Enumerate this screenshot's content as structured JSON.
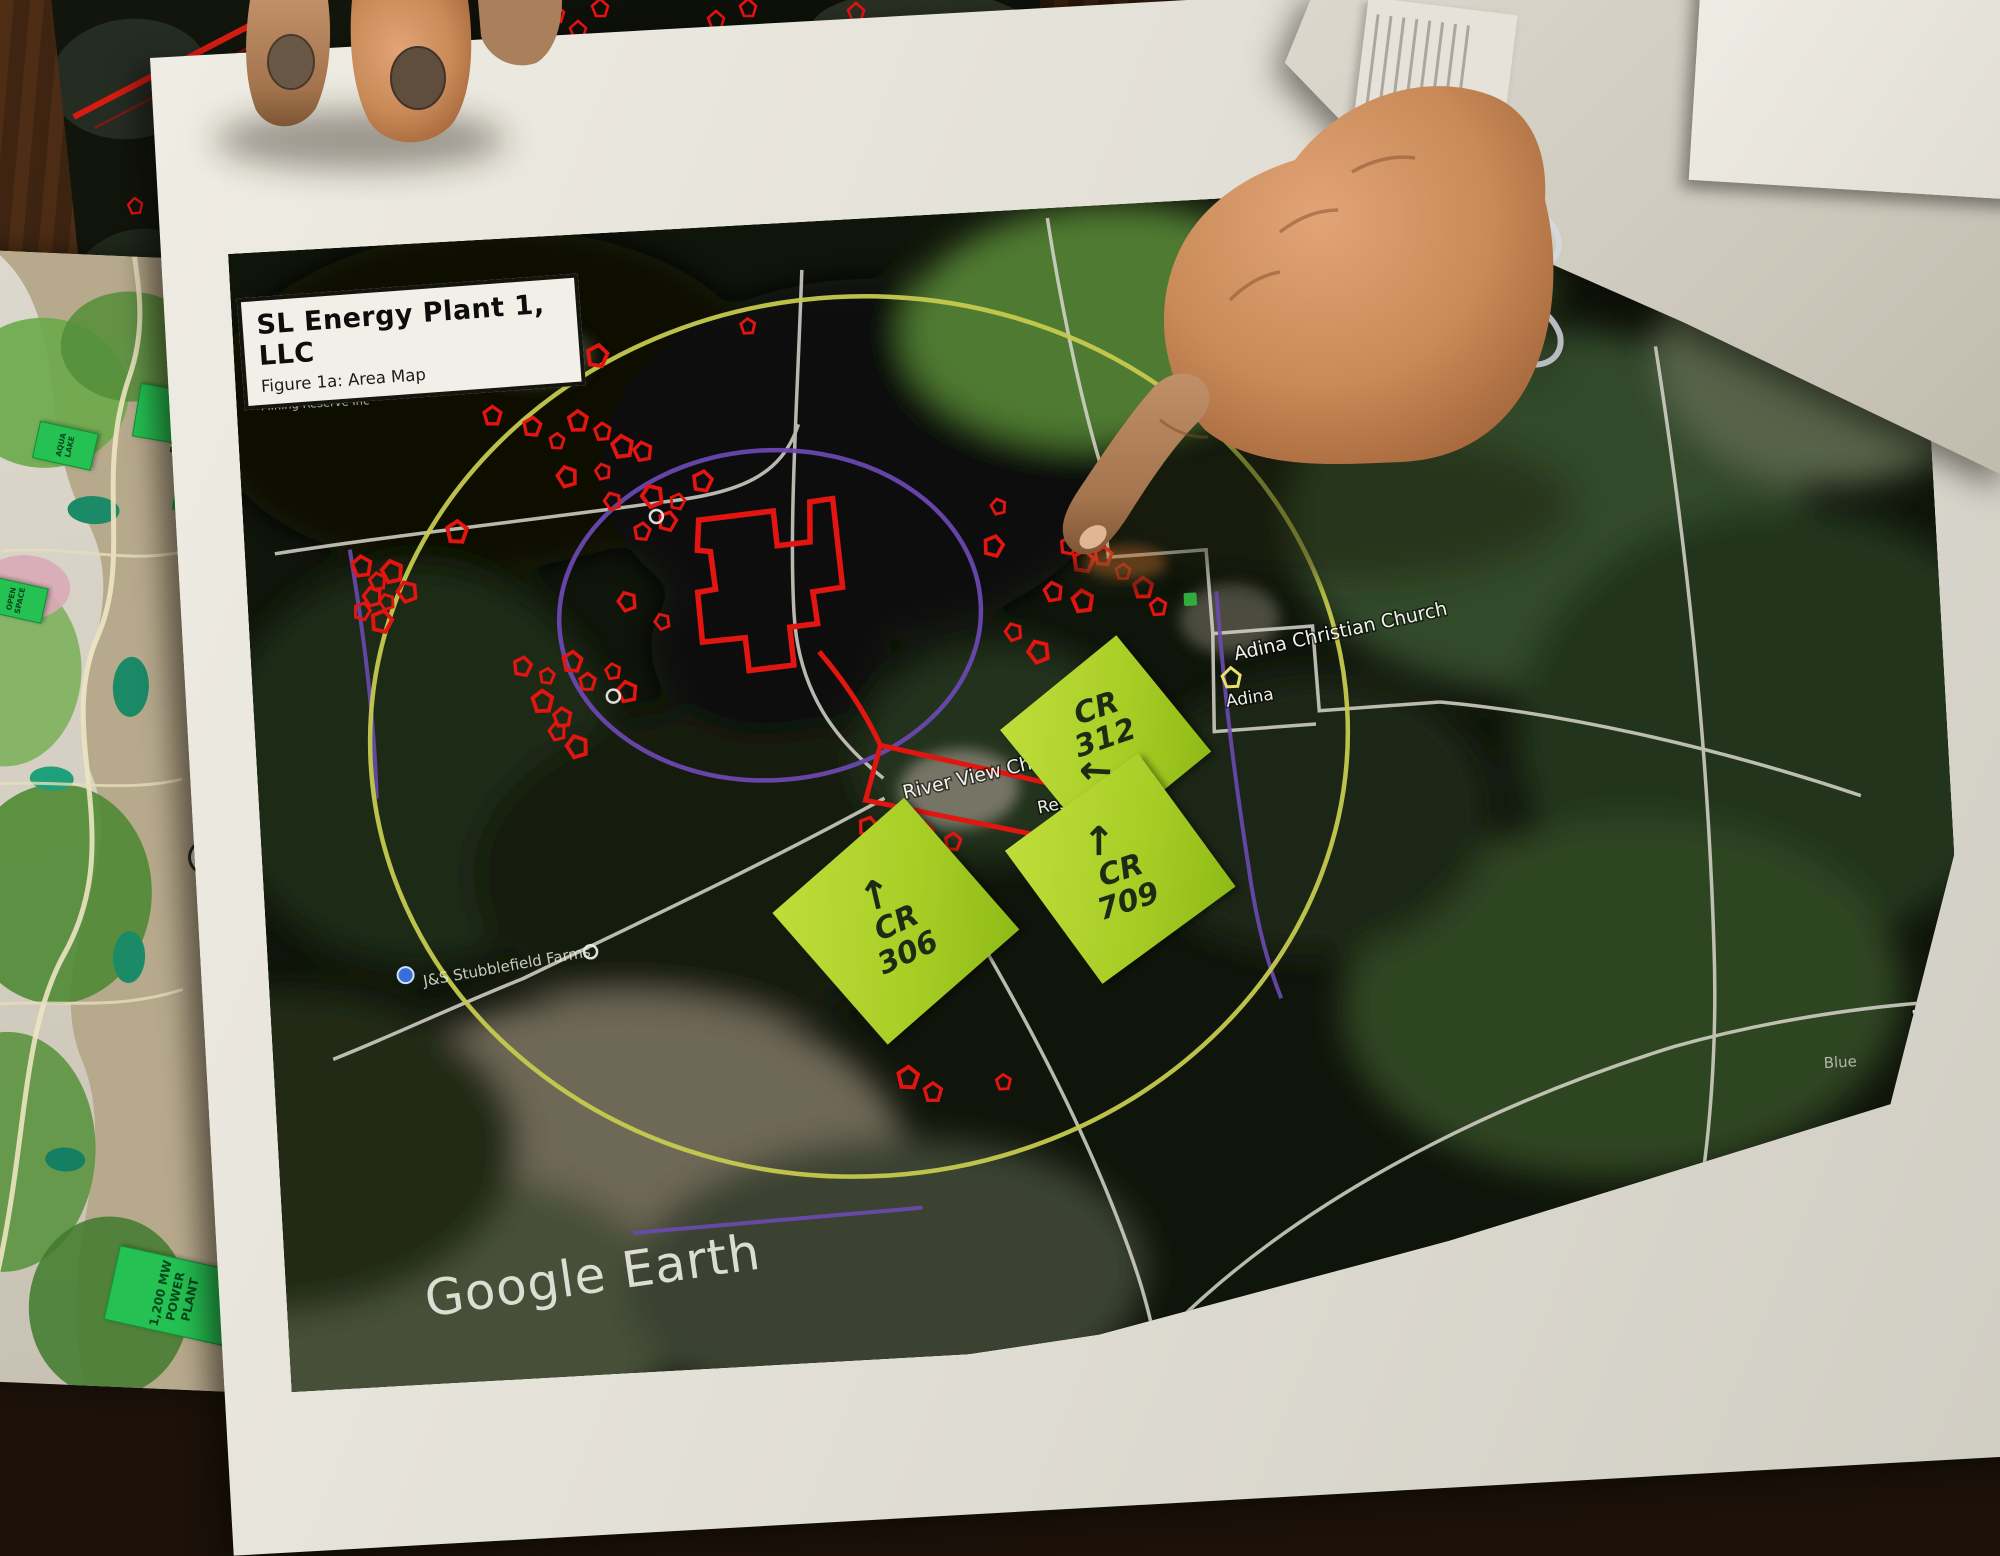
{
  "scene": {
    "caption": "Hand pointing at printed Google Earth area map with sticky notes"
  },
  "main_map": {
    "title": "SL Energy Plant 1, LLC",
    "subtitle": "Figure 1a: Area Map",
    "legend_title": "Legend",
    "watermark": "Google Earth",
    "scale_label": "2 mi",
    "place_labels": {
      "reserve": "Mining Reserve Inc",
      "church": "Adina Christian Church",
      "town": "Adina",
      "academy": "River View Christian Academy",
      "residence": "Residence",
      "farms": "J&S Stubblefield Farms",
      "blue": "Blue"
    },
    "sticky_notes": [
      {
        "road": "CR",
        "number": "312",
        "arrow": "←"
      },
      {
        "road": "CR",
        "number": "709",
        "arrow": "↑"
      },
      {
        "road": "CR",
        "number": "306",
        "arrow": "↑"
      }
    ],
    "colors": {
      "radius_ring_outer": "#c6ca4e",
      "radius_ring_inner": "#6a48b0",
      "marker_red": "#e21510",
      "site_boundary_red": "#e21510",
      "sticky_green": "#a7cd25",
      "scale_dot_orange": "#ff7a1a"
    },
    "markers": [
      [
        292,
        143
      ],
      [
        313,
        120
      ],
      [
        338,
        116
      ],
      [
        363,
        122
      ],
      [
        294,
        189
      ],
      [
        318,
        205
      ],
      [
        340,
        186
      ],
      [
        364,
        198
      ],
      [
        383,
        214
      ],
      [
        403,
        220
      ],
      [
        362,
        238
      ],
      [
        326,
        241
      ],
      [
        370,
        268
      ],
      [
        410,
        265
      ],
      [
        424,
        291
      ],
      [
        435,
        272
      ],
      [
        461,
        253
      ],
      [
        398,
        300
      ],
      [
        213,
        290
      ],
      [
        255,
        176
      ],
      [
        515,
        101
      ],
      [
        116,
        319
      ],
      [
        131,
        335
      ],
      [
        146,
        326
      ],
      [
        125,
        350
      ],
      [
        139,
        356
      ],
      [
        160,
        347
      ],
      [
        114,
        364
      ],
      [
        133,
        375
      ],
      [
        271,
        428
      ],
      [
        295,
        439
      ],
      [
        321,
        426
      ],
      [
        335,
        447
      ],
      [
        289,
        464
      ],
      [
        308,
        481
      ],
      [
        361,
        438
      ],
      [
        374,
        459
      ],
      [
        302,
        495
      ],
      [
        321,
        511
      ],
      [
        379,
        369
      ],
      [
        413,
        391
      ],
      [
        748,
        334
      ],
      [
        823,
        338
      ],
      [
        837,
        354
      ],
      [
        857,
        350
      ],
      [
        876,
        367
      ],
      [
        895,
        384
      ],
      [
        909,
        404
      ],
      [
        834,
        394
      ],
      [
        805,
        383
      ],
      [
        755,
        295
      ],
      [
        910,
        654
      ],
      [
        763,
        421
      ],
      [
        787,
        442
      ],
      [
        607,
        607
      ],
      [
        621,
        623
      ],
      [
        662,
        616
      ],
      [
        691,
        627
      ],
      [
        633,
        860
      ],
      [
        657,
        876
      ],
      [
        728,
        870
      ]
    ],
    "rings": [
      [
        413,
        286
      ],
      [
        360,
        463
      ],
      [
        323,
        717
      ]
    ]
  },
  "plan_map": {
    "labels": {
      "village": "RESIDENTIAL\nVILLAGE 1",
      "campus": "HEALTH &\nWELLNESS\nCAMPUS",
      "aqua": "AQUA\nLAKE",
      "open": "OPEN\nSPACE",
      "plant": "1,200 MW\nPOWER PLANT"
    },
    "compass": "N"
  }
}
